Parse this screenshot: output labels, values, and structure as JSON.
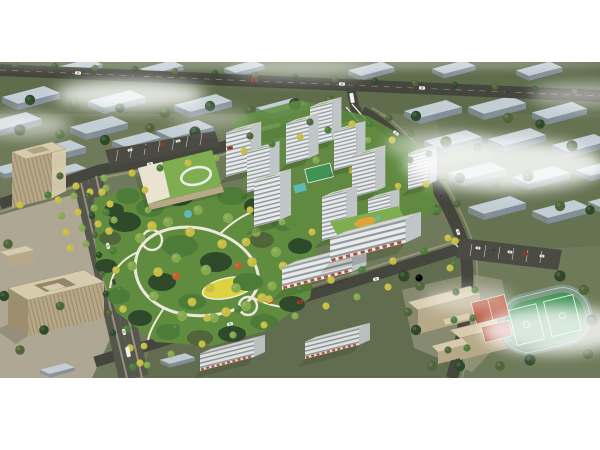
{
  "scene": {
    "type": "aerial architectural rendering",
    "description": "Bird's-eye masterplan rendering of a residential development: a lush central park with winding white paths and a yellow lawn, a kindergarten with a green roof, a cluster of white high-rise apartment towers with green courtyards, mid-rise retail slabs along a tree-lined street, beige office buildings with a plaza at lower left, a school campus with red courts and a green sports field with running track at lower right, all framed by faded blue-grey context blocks, boulevards with yellow street trees, and drifting clouds. White margins above and below the image.",
    "time_of_day": "day",
    "style": "photorealistic CGI, isometric bird's-eye view"
  },
  "palette": {
    "white": "#ffffff",
    "land": "#6e7a59",
    "landTop": "#5e6b4b",
    "road": "#45463e",
    "roadLight": "#55564c",
    "sidewalk": "#a19a88",
    "plaza": "#b5ac99",
    "blockTop": "#c7d1da",
    "blockSide": "#84919d",
    "treeDark": "#2f4a2b",
    "treeOlive": "#50663a",
    "treeMid": "#4c7c38",
    "treeLight": "#85a94e",
    "treeYellow": "#c6bd45",
    "treeOrange": "#b9642f",
    "parkLawn": "#5f8c3e",
    "lawnYellow": "#ddd23f",
    "path": "#ece8da",
    "towerFace": "#eaebe8",
    "towerSide": "#c0c5c7",
    "towerWin": "#8d98a1",
    "roof": "#d9dbd7",
    "roofGreen": "#7fae51",
    "beigeTop": "#d7cbad",
    "beigeSide": "#b7a988",
    "beigeDark": "#9c8e6e",
    "fieldGreen": "#3f9355",
    "trackGray": "#7e9a85",
    "courtRed": "#b34b31",
    "teal": "#5fb8b4",
    "parking": "#4b4b44",
    "carWhite": "#f2f2ef",
    "carDark": "#474c52",
    "carRed": "#b23a2e",
    "lineWhite": "#e9efe6",
    "fog": "#ffffff"
  },
  "elements": [
    {
      "name": "central-park",
      "description": "landscaped park with looping pedestrian paths, yellow lawn and dense mixed trees"
    },
    {
      "name": "kindergarten-building",
      "description": "low white building with green roof and white rooftop loop"
    },
    {
      "name": "residential-towers",
      "description": "ten white high-rise apartment slabs with banded windows"
    },
    {
      "name": "retail-street-buildings",
      "description": "mid-rise slabs with ground-floor retail along the south street"
    },
    {
      "name": "office-buildings",
      "description": "beige striped office blocks with rooftop courtyard at lower left"
    },
    {
      "name": "school-campus",
      "description": "beige school slabs, red courts, green pitch with running track"
    },
    {
      "name": "context-buildings",
      "description": "faded blue-grey massing blocks surrounding the site"
    },
    {
      "name": "boulevard",
      "description": "wide tree-lined avenue with median trees, cars and a bus"
    },
    {
      "name": "clouds",
      "description": "soft white fog patches drifting over the model"
    }
  ]
}
